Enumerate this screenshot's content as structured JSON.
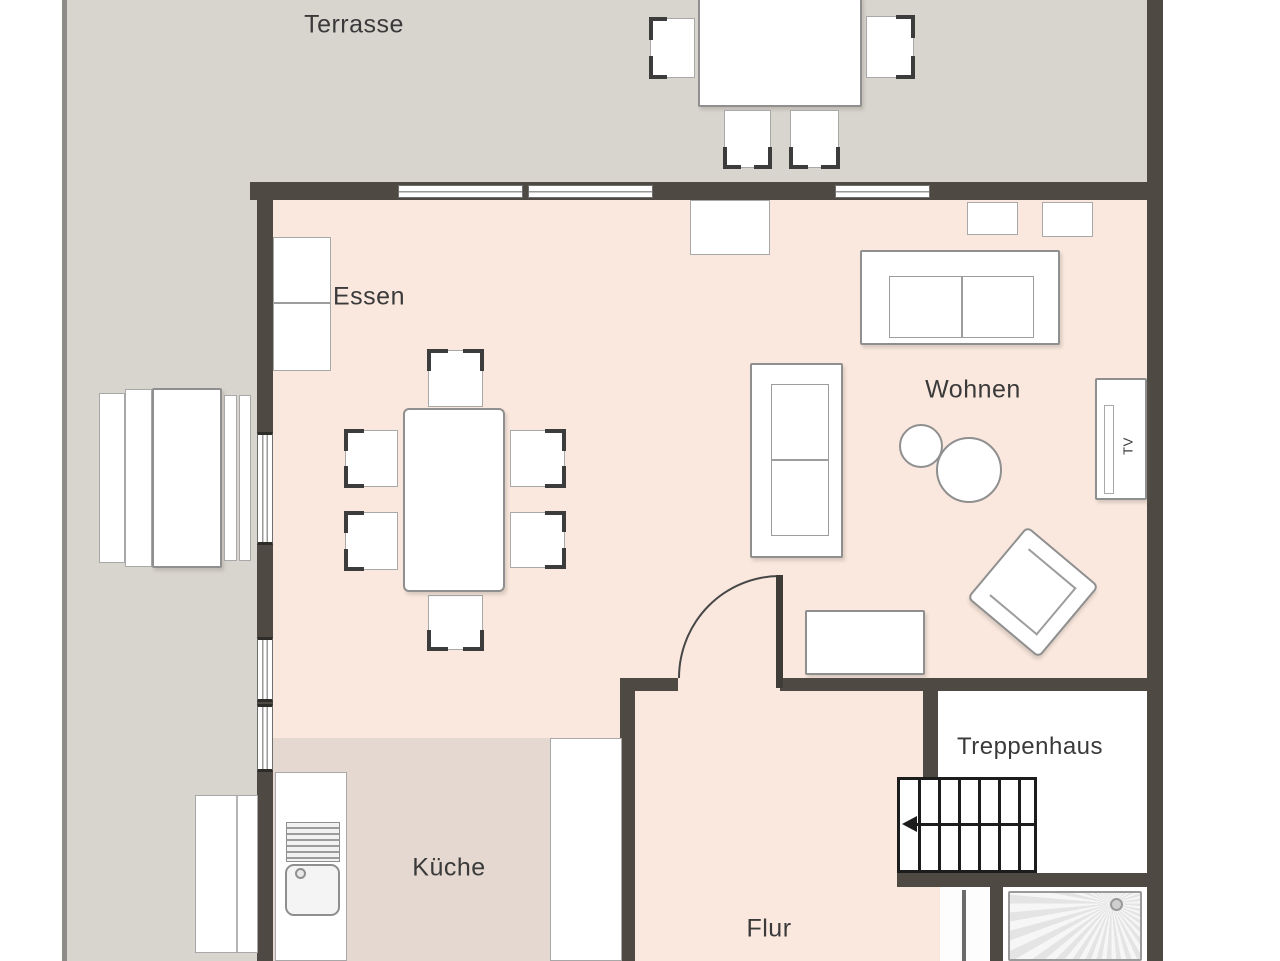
{
  "colors": {
    "wall": "#4e4a43",
    "terrace_floor": "#d8d4ce",
    "living_floor": "#fae8de",
    "kitchen_floor": "#e4d8d0",
    "label_text": "#3a3a3a",
    "stair_line": "#1c1c1c",
    "furniture_border": "#9a9a9a"
  },
  "rooms": {
    "terrasse": {
      "label": "Terrasse"
    },
    "essen": {
      "label": "Essen"
    },
    "wohnen": {
      "label": "Wohnen"
    },
    "kueche": {
      "label": "Küche"
    },
    "flur": {
      "label": "Flur"
    },
    "treppenhaus": {
      "label": "Treppenhaus"
    }
  },
  "furniture": {
    "tv_label": "TV"
  }
}
